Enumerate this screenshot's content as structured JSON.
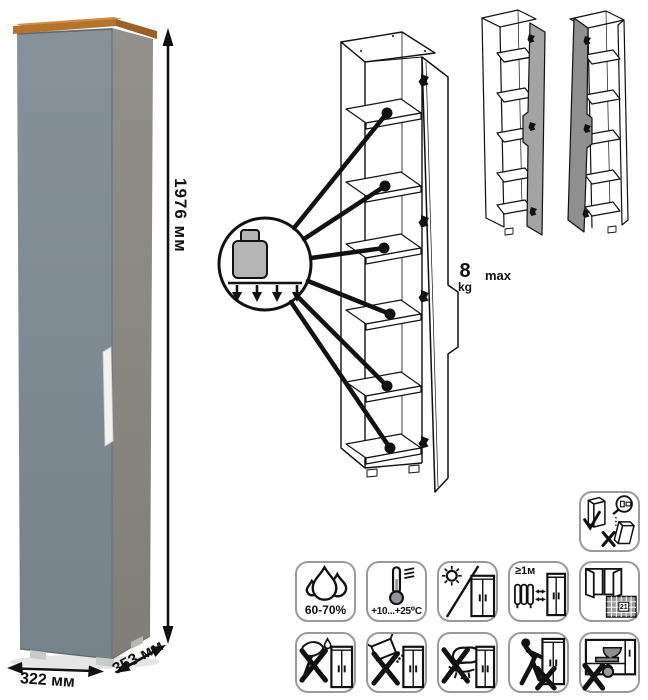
{
  "photo": {
    "height_label": "1976 мм",
    "width_label": "322 мм",
    "depth_label": "353 мм"
  },
  "load_callout": {
    "value": "8",
    "unit": "kg",
    "qualifier": "max",
    "shelf_callouts": 6
  },
  "colors": {
    "wood_top": "#b5742e",
    "door_front": "#808c94",
    "side_panel": "#8e8b85",
    "line_art": "#111111",
    "icon_border": "#9a9a9a"
  },
  "icons": {
    "anti_tip": {
      "name": "wall-mount-anti-tip-icon"
    },
    "row1": [
      {
        "name": "humidity-icon",
        "label": "60-70%"
      },
      {
        "name": "temperature-range-icon",
        "label": "+10...+25⁰C"
      },
      {
        "name": "no-direct-sunlight-icon"
      },
      {
        "name": "heater-distance-icon",
        "label": "≥1м"
      },
      {
        "name": "ventilation-calendar-icon",
        "day": "21"
      }
    ],
    "row2": [
      {
        "name": "no-sharp-tools-icon"
      },
      {
        "name": "no-abrasive-powder-icon"
      },
      {
        "name": "no-wet-sponge-icon"
      },
      {
        "name": "no-dragging-icon"
      },
      {
        "name": "no-heavy-items-icon"
      }
    ]
  }
}
